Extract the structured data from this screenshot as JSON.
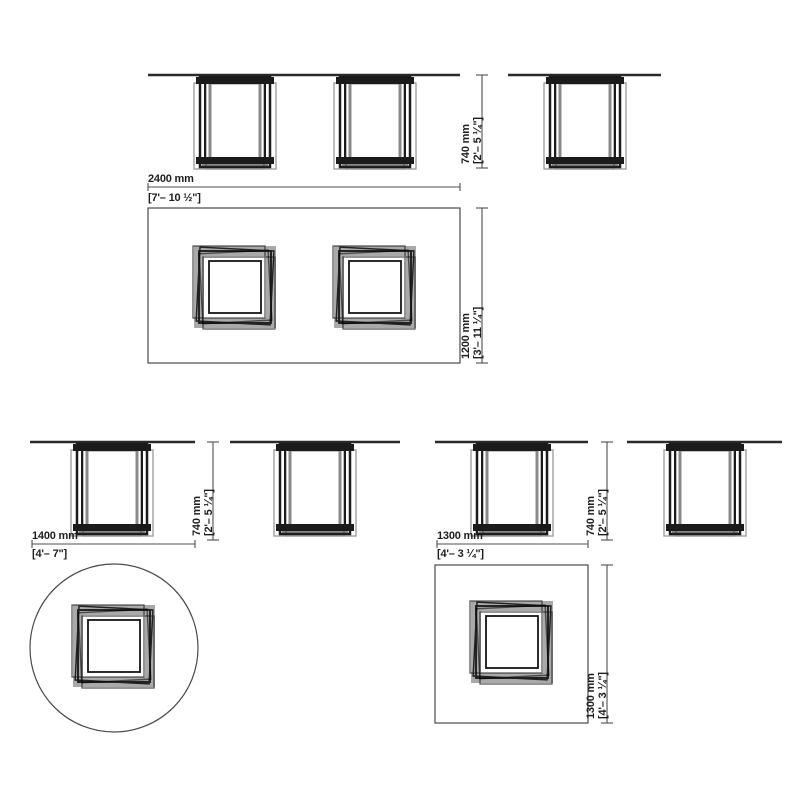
{
  "tables": [
    {
      "shape": "rectangular",
      "width": {
        "mm": "2400 mm",
        "imperial": "[7'– 10 ½\"]"
      },
      "depth": {
        "mm": "1200 mm",
        "imperial": "[3'– 11 ¼\"]"
      },
      "height": {
        "mm": "740 mm",
        "imperial": "[2'– 5 ¼\"]"
      }
    },
    {
      "shape": "round",
      "width": {
        "mm": "1400 mm",
        "imperial": "[4'– 7\"]"
      },
      "height": {
        "mm": "740 mm",
        "imperial": "[2'– 5 ¼\"]"
      }
    },
    {
      "shape": "square",
      "width": {
        "mm": "1300 mm",
        "imperial": "[4'– 3 ¼\"]"
      },
      "depth": {
        "mm": "1300 mm",
        "imperial": "[4'– 3 ¼\"]"
      },
      "height": {
        "mm": "740 mm",
        "imperial": "[2'– 5 ¼\"]"
      }
    }
  ],
  "colors": {
    "background": "#ffffff",
    "line_dark": "#1b1b1b",
    "line_gray": "#979797",
    "dimension_line": "#4f4f4f",
    "text": "#1e1e1e"
  }
}
